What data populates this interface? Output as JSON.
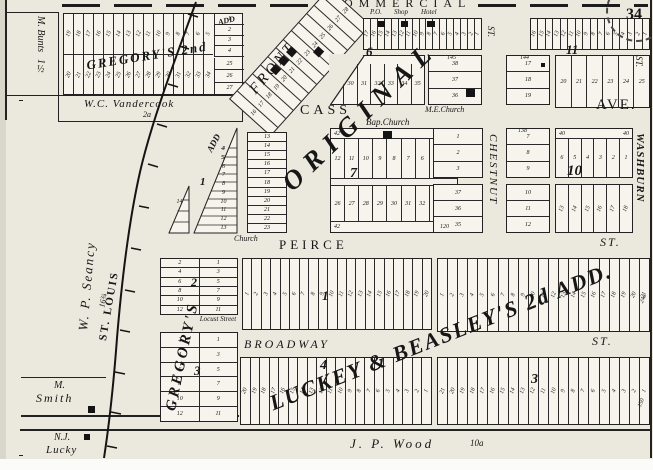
{
  "stamp": {
    "number": "34"
  },
  "streets": {
    "commercial": "COMMERCIAL",
    "front": "FRONT",
    "cass": "CASS",
    "cass_ave": "AVE.",
    "peirce": "PEIRCE",
    "peirce_st": "ST.",
    "broadway": "BROADWAY",
    "broadway_st": "ST.",
    "chestnut": "CHESTNUT",
    "chestnut_st": "ST.",
    "washburn": "WASHBURN",
    "washburn_st": "ST.",
    "locust": "Locust Street",
    "railroad": "ST. LOUIS"
  },
  "additions": {
    "gregorys_2nd": "GREGORY'S 2nd",
    "gregorys_2nd_suffix": "ADD",
    "original": "ORIGINAL",
    "gregorys": "GREGORY'S",
    "luckey_beasley": "LUCKEY & BEASLEY'S 2d ADD.",
    "wedge_add": "ADD"
  },
  "owners": {
    "bunts": "M. Bunts",
    "bunts_acres": "1½",
    "vandercook": "W.C. Vandercook",
    "vandercook_acres": "2a",
    "seancy": "W. P. Seancy",
    "seancy_acres": "16¾",
    "smith_first": "M.",
    "smith_last": "Smith",
    "lucky_first": "N.J.",
    "lucky_last": "Lucky",
    "wood": "J. P. Wood",
    "wood_acres": "10a"
  },
  "landmarks": {
    "po": "P.O.",
    "shop": "Shop",
    "hotel": "Hotel",
    "me_church": "M.E.Church",
    "bap_church": "Bap.Church",
    "church": "Church"
  },
  "blocks": {
    "gregorys2_top": [
      "19",
      "18",
      "17",
      "16",
      "15",
      "14",
      "13",
      "12",
      "11",
      "10",
      "9",
      "8",
      "7",
      "6",
      "5"
    ],
    "gregorys2_bottom": [
      "20",
      "21",
      "22",
      "23",
      "24",
      "25",
      "26",
      "27",
      "28",
      "29",
      "30",
      "31",
      "32",
      "33",
      "34"
    ],
    "gregorys2_east_top": [
      "1",
      "2",
      "3",
      "4"
    ],
    "gregorys2_east_bottom": [
      "25",
      "26",
      "27"
    ],
    "front_block": [
      "16",
      "17",
      "18",
      "19",
      "20",
      "21",
      "22",
      "23",
      "24",
      "25",
      "26",
      "27",
      "28"
    ],
    "row_a": [
      "17",
      "16",
      "15",
      "14",
      "13",
      "12",
      "11",
      "10",
      "9",
      "8",
      "7",
      "6",
      "5",
      "4",
      "3",
      "2",
      "1"
    ],
    "row_b": [
      "16",
      "15",
      "14",
      "13",
      "12",
      "11",
      "10",
      "9",
      "8",
      "7",
      "6",
      "5",
      "4",
      "3",
      "2",
      "1"
    ],
    "block6": {
      "number": "6",
      "lots": [
        "29",
        "30",
        "31",
        "32",
        "33",
        "34",
        "35"
      ]
    },
    "me_block": {
      "note": "145",
      "lots": [
        "38",
        "37",
        "36"
      ]
    },
    "block17": {
      "note": "144",
      "lots": [
        "17",
        "18",
        "19"
      ]
    },
    "block11": {
      "number": "11",
      "lots": [
        "20",
        "21",
        "22",
        "23",
        "24",
        "25"
      ]
    },
    "wedge": {
      "number": "1",
      "lots": [
        "4",
        "5",
        "6",
        "7",
        "8",
        "9",
        "10",
        "11",
        "12",
        "13"
      ],
      "small_lots": [
        "14",
        "15",
        "16"
      ],
      "note": "43"
    },
    "church_column": [
      "13",
      "14",
      "15",
      "16",
      "17",
      "18",
      "19",
      "20",
      "21",
      "22",
      "23"
    ],
    "block7": {
      "number": "7",
      "corner_left": "42",
      "corner_right": "48 50",
      "top": [
        "12",
        "11",
        "10",
        "9",
        "8",
        "7",
        "6",
        "5",
        "4"
      ],
      "bottom": [
        "26",
        "27",
        "28",
        "29",
        "30",
        "31",
        "32",
        "33",
        "34"
      ]
    },
    "block8a": {
      "top": [
        "1",
        "2",
        "3"
      ],
      "bottom": [
        "37",
        "36",
        "35"
      ],
      "note": "120"
    },
    "block8b": {
      "note": "138",
      "top": [
        "7",
        "8",
        "9"
      ],
      "bottom": [
        "10",
        "11",
        "12"
      ]
    },
    "block10": {
      "number": "10",
      "corner": "40",
      "top": [
        "6",
        "5",
        "4",
        "3",
        "2",
        "1"
      ],
      "bottom": [
        "13",
        "14",
        "15",
        "16",
        "17",
        "18"
      ]
    },
    "gregory_block2": {
      "number": "2",
      "west": [
        "2",
        "4",
        "6",
        "8",
        "10",
        "12"
      ],
      "east": [
        "1",
        "3",
        "5",
        "7",
        "9",
        "11"
      ]
    },
    "gregory_block3": {
      "number": "3",
      "west": [
        "2",
        "4",
        "6",
        "8",
        "10",
        "12"
      ],
      "east": [
        "1",
        "3",
        "5",
        "7",
        "9",
        "11"
      ]
    },
    "lb_block1": {
      "number": "1",
      "lots": [
        "1",
        "2",
        "3",
        "4",
        "5",
        "6",
        "7",
        "8",
        "9",
        "10",
        "11",
        "12",
        "13",
        "14",
        "15",
        "16",
        "17",
        "18",
        "19",
        "20"
      ]
    },
    "lb_block2": {
      "note": "24a",
      "lots": [
        "1",
        "2",
        "3",
        "4",
        "5",
        "6",
        "7",
        "8",
        "9",
        "10",
        "11",
        "12",
        "13",
        "14",
        "15",
        "16",
        "17",
        "18",
        "19",
        "20",
        "21"
      ]
    },
    "lb_block4": {
      "number": "4",
      "lots": [
        "20",
        "19",
        "18",
        "17",
        "16",
        "15",
        "14",
        "13",
        "12",
        "11",
        "10",
        "9",
        "8",
        "7",
        "6",
        "5",
        "4",
        "3",
        "2",
        "1"
      ]
    },
    "lb_block3": {
      "number": "3",
      "note": "150",
      "lots": [
        "21",
        "20",
        "19",
        "18",
        "17",
        "16",
        "15",
        "14",
        "13",
        "12",
        "11",
        "10",
        "9",
        "8",
        "7",
        "6",
        "5",
        "4",
        "3",
        "2",
        "1"
      ]
    }
  }
}
